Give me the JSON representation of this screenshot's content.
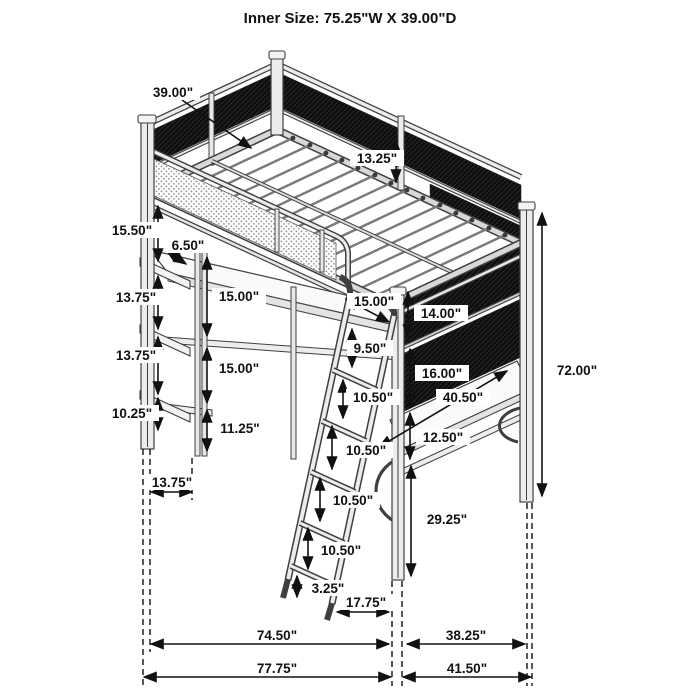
{
  "title": "Inner Size: 75.25\"W X 39.00\"D",
  "diagram": {
    "subject": "isometric dimension drawing of a metal loft bed with desk, shelves and ladder",
    "inner_width": "75.25\"",
    "inner_depth": "39.00\""
  },
  "dims": {
    "d39": "39.00\"",
    "d1325": "13.25\"",
    "d1550": "15.50\"",
    "d650": "6.50\"",
    "d1375a": "13.75\"",
    "d1500a": "15.00\"",
    "d1375b": "13.75\"",
    "d1500b": "15.00\"",
    "d1025": "10.25\"",
    "d1125": "11.25\"",
    "d1500c": "15.00\"",
    "d1400": "14.00\"",
    "d950": "9.50\"",
    "d1600": "16.00\"",
    "d1050a": "10.50\"",
    "d4050": "40.50\"",
    "d1250": "12.50\"",
    "d1050b": "10.50\"",
    "d1050c": "10.50\"",
    "d2925": "29.25\"",
    "d1050d": "10.50\"",
    "d325": "3.25\"",
    "d1775": "17.75\"",
    "d7200": "72.00\"",
    "d1375w": "13.75\"",
    "d7450": "74.50\"",
    "d3825": "38.25\"",
    "d7775": "77.75\"",
    "d4150": "41.50\""
  }
}
